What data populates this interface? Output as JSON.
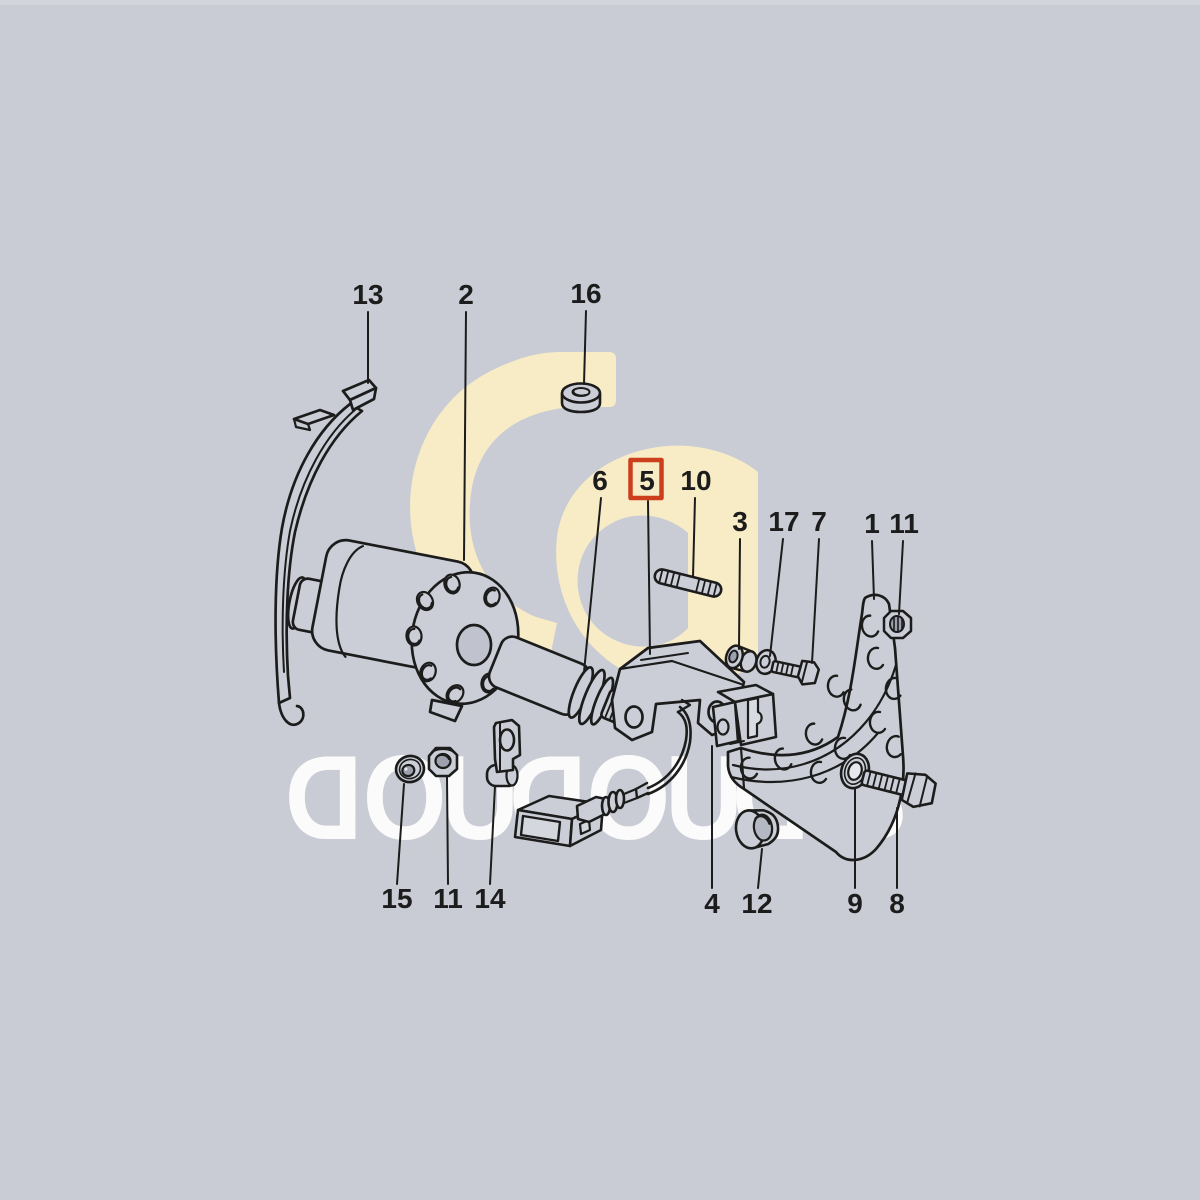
{
  "colors": {
    "background": "#c9ccd4",
    "line_art": "#1c1c1c",
    "monogram": "#f8ecc6",
    "watermark_text": "#ffffff",
    "highlight_box": "#cc3e1c",
    "part_fill": "#cbced6"
  },
  "watermark": {
    "text": "DOUDOUDIS",
    "monogram_icon": "gd-monogram"
  },
  "highlight": {
    "part_number": "5"
  },
  "part_labels": [
    {
      "number": "13"
    },
    {
      "number": "2"
    },
    {
      "number": "16"
    },
    {
      "number": "6"
    },
    {
      "number": "5"
    },
    {
      "number": "10"
    },
    {
      "number": "3"
    },
    {
      "number": "17"
    },
    {
      "number": "7"
    },
    {
      "number": "1"
    },
    {
      "number": "11"
    },
    {
      "number": "15"
    },
    {
      "number": "11"
    },
    {
      "number": "14"
    },
    {
      "number": "4"
    },
    {
      "number": "12"
    },
    {
      "number": "9"
    },
    {
      "number": "8"
    }
  ]
}
